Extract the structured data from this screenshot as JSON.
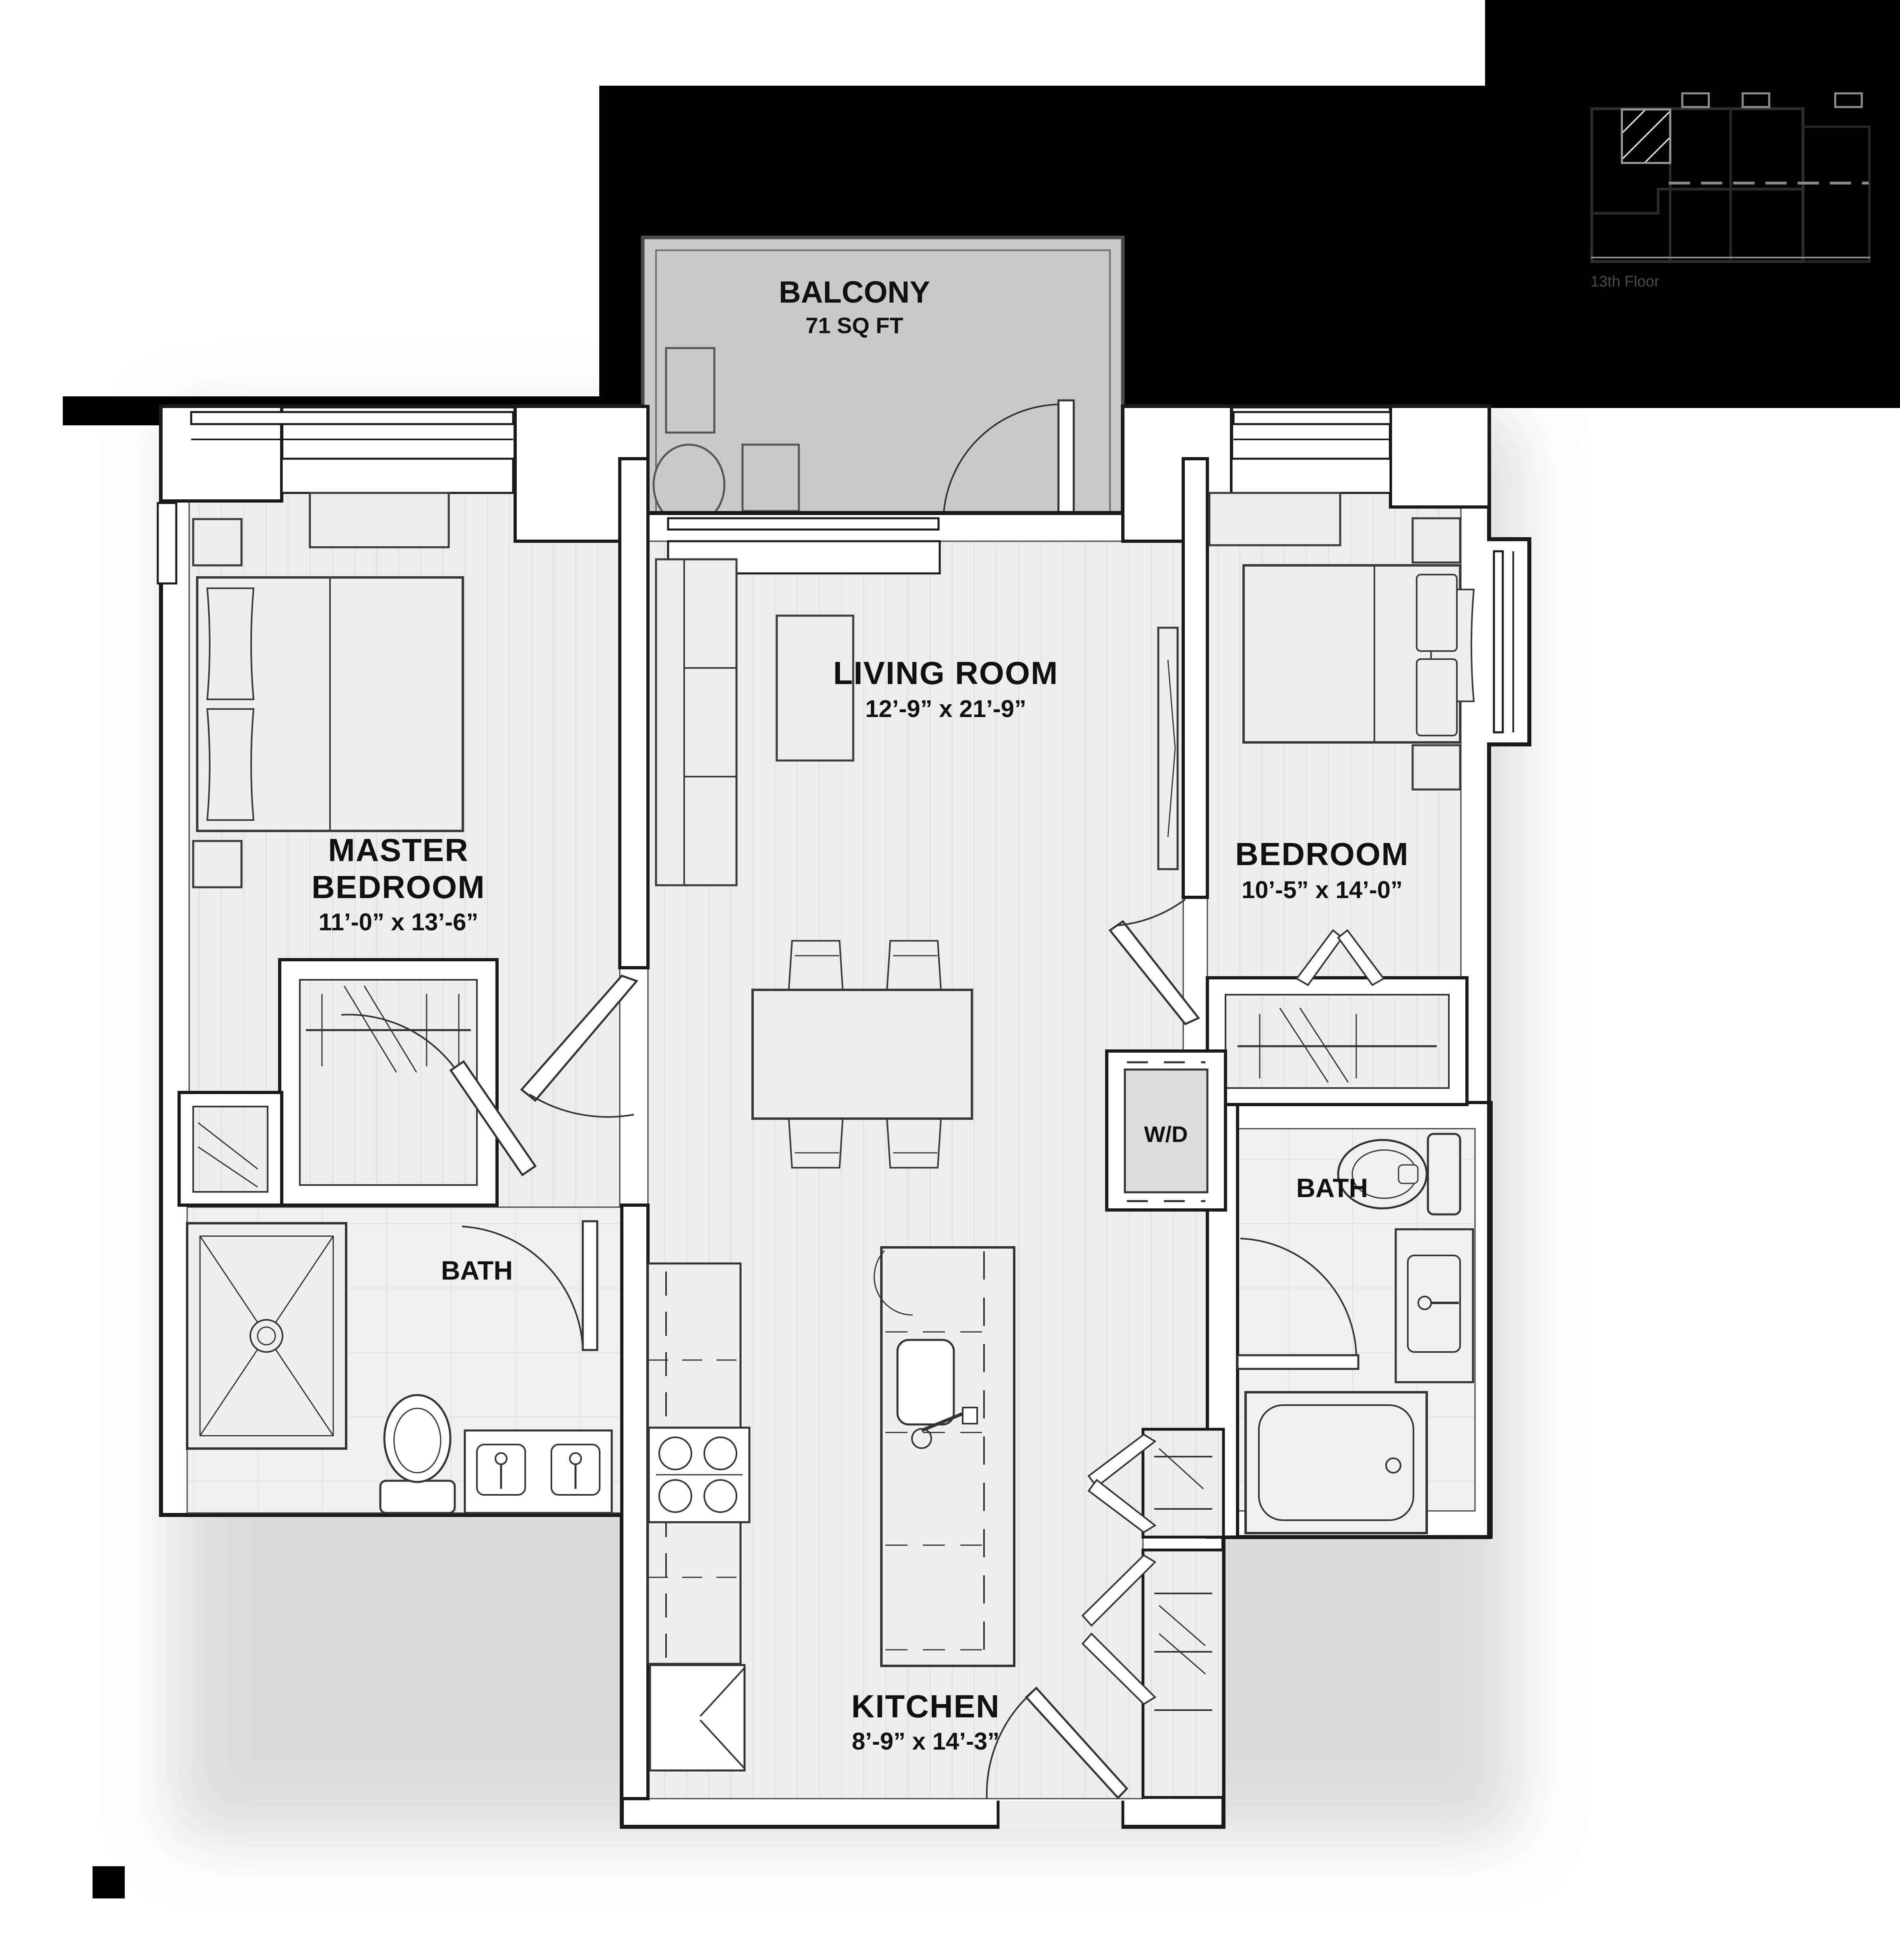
{
  "plan": {
    "balcony": {
      "name": "BALCONY",
      "area": "71 SQ FT"
    },
    "living_room": {
      "name": "LIVING ROOM",
      "dims": "12’-9” x 21’-9”"
    },
    "master_bedroom": {
      "name_line1": "MASTER",
      "name_line2": "BEDROOM",
      "dims": "11’-0” x 13’-6”"
    },
    "bedroom": {
      "name": "BEDROOM",
      "dims": "10’-5” x 14’-0”"
    },
    "kitchen": {
      "name": "KITCHEN",
      "dims": "8’-9” x 14’-3”"
    },
    "master_bath": {
      "name": "BATH"
    },
    "bath2": {
      "name": "BATH"
    },
    "laundry": {
      "name": "W/D"
    }
  },
  "keyplan": {
    "floor_label": "13th Floor"
  },
  "colors": {
    "background_mask": "#000000",
    "page": "#ffffff",
    "balcony_fill": "#c9c9c9",
    "floor_fill": "#ededed",
    "tile_fill": "#f0f0f0",
    "wall_stroke": "#1a1a1a",
    "furniture_stroke": "#3a3a3a",
    "keyplan_line": "#2f2f2f"
  }
}
